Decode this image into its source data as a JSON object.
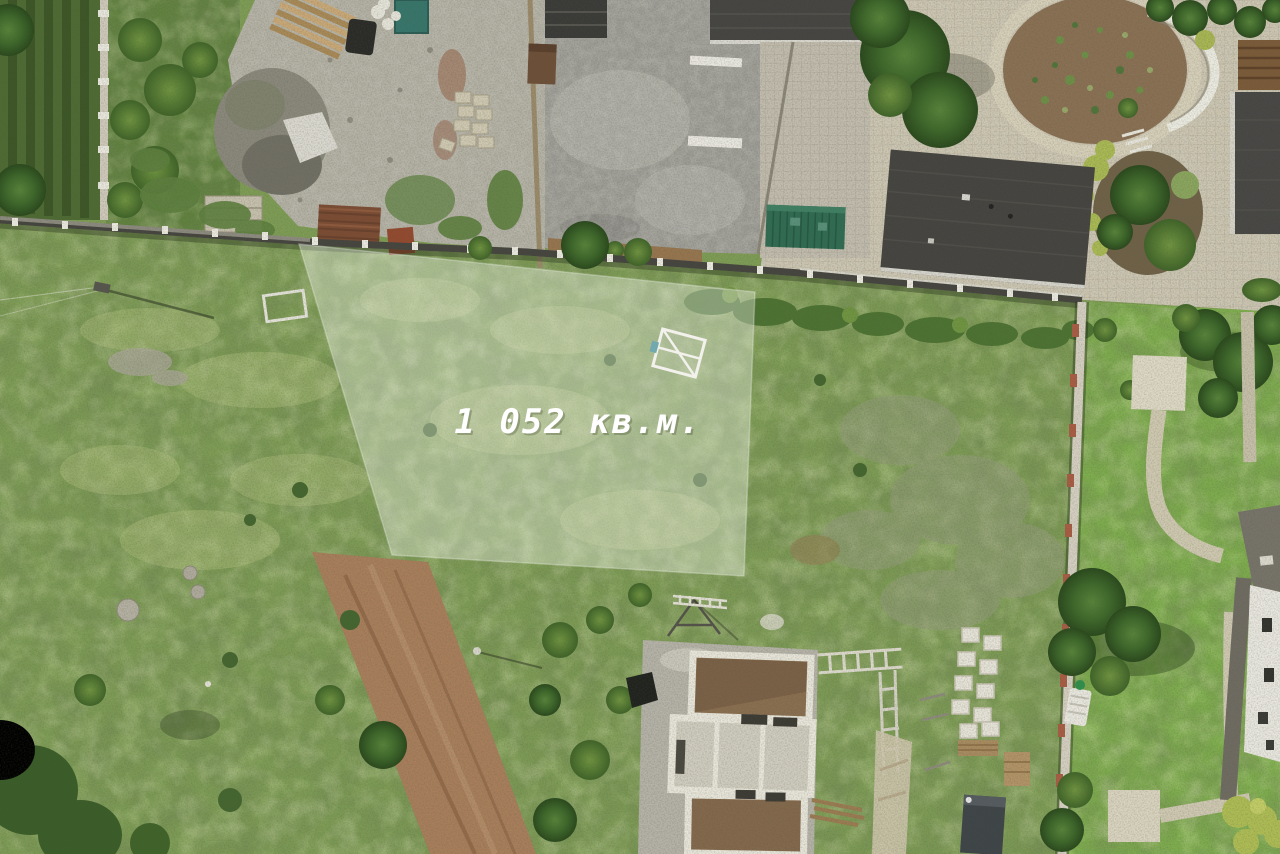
{
  "overlay": {
    "area_label": "1 052 кв.м.",
    "label_color": "#ffffff",
    "highlight_fill": "rgba(255,255,255,0.33)",
    "highlight_stroke": "rgba(255,255,255,0.28)"
  },
  "palette": {
    "meadow_green": "#7e9c55",
    "lawn_green": "#7fae4e",
    "asphalt_gray": "#9d9c96",
    "gravel_gray": "#b3b0a4",
    "paving_beige": "#cdc6b2",
    "roof_dark": "#454341",
    "dirt_road_brown": "#a87e5c",
    "shed_green": "#2f6b52",
    "fence_dark": "#45443f",
    "fence_post_red": "#a85c44"
  }
}
